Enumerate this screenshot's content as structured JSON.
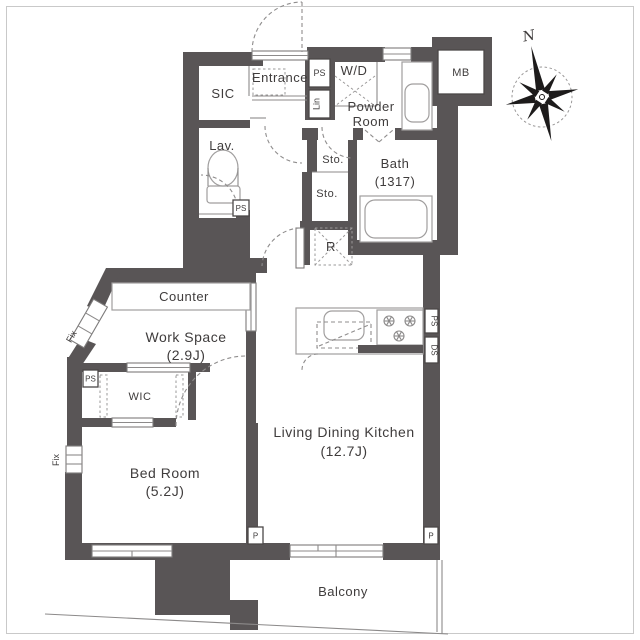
{
  "plan_type": "apartment-floor-plan",
  "rooms": {
    "sic": "SIC",
    "entrance": "Entrance",
    "lav": "Lav.",
    "powder_line1": "Powder",
    "powder_line2": "Room",
    "bath": "Bath",
    "bath_size": "(1317)",
    "sto_upper": "Sto.",
    "sto_lower": "Sto.",
    "wd": "W/D",
    "counter": "Counter",
    "work_space": "Work Space",
    "work_space_size": "(2.9J)",
    "wic": "WIC",
    "bed_room": "Bed Room",
    "bed_room_size": "(5.2J)",
    "ldk": "Living Dining Kitchen",
    "ldk_size": "(12.7J)",
    "balcony": "Balcony"
  },
  "boxes": {
    "mb": "MB",
    "ps_entry": "PS",
    "lin": "Lin",
    "ps_lav": "PS",
    "ps_wic": "PS",
    "ps_kitchen": "PS",
    "ds_kitchen": "DS",
    "r_fridge": "R",
    "p_left": "P",
    "p_right": "P",
    "fix_upper": "Fix",
    "fix_lower": "Fix"
  },
  "compass": {
    "north": "N"
  },
  "colors": {
    "wall": "#595556",
    "line": "#8c8a8a",
    "dashed": "#8f8d8d",
    "text": "#3f3c3c",
    "frame": "#c9c9c9"
  }
}
